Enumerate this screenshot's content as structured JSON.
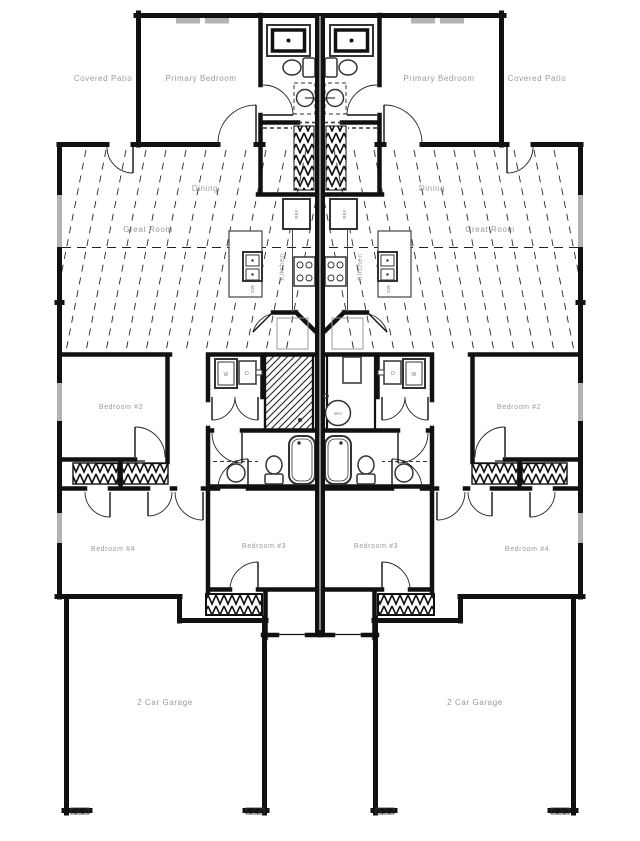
{
  "drawing": {
    "type": "duplex-floor-plan",
    "units": 2,
    "colors": {
      "wall": "#111111",
      "fixture": "#333333",
      "label": "#9a9a9a",
      "window": "#b3b3b3",
      "background": "#ffffff"
    }
  },
  "rooms": {
    "covered_patio": "Covered Patio",
    "primary_bedroom": "Primary Bedroom",
    "dining": "Dining",
    "great_room": "Great Room",
    "kitchen": "Kitchen",
    "bedroom_2": "Bedroom #2",
    "bedroom_3": "Bedroom #3",
    "bedroom_4": "Bedroom #4",
    "garage": "2 Car Garage"
  },
  "fixtures": {
    "refrigerator": "REF",
    "dishwasher": "DW",
    "washer": "W",
    "dryer": "D",
    "water_heater": "WH"
  }
}
